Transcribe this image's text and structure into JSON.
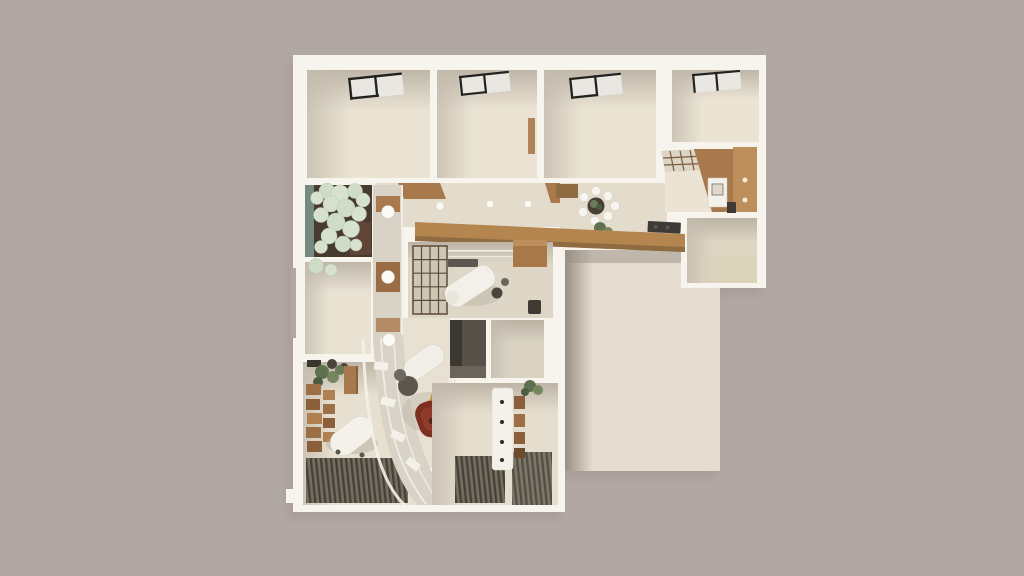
{
  "meta": {
    "canvas": {
      "width": 1024,
      "height": 576
    },
    "visible_text": [],
    "description": "Top-down 3D architectural render of a single floor plan on a plain warm-gray backdrop; no text, labels or UI controls are visible in the image."
  },
  "palette": {
    "bg": "#b2a8a3",
    "wall": "#f7f4ee",
    "wallShade": "#d9d3c7",
    "floor": "#ebe4d4",
    "floorDark": "#ded7c8",
    "floorCorridor": "#e3dccc",
    "terrace": "#e5ded0",
    "shadow": "#9c9189",
    "wood": "#a9794e",
    "woodLight": "#bd8f5c",
    "woodDark": "#8f6b42",
    "windowFrame": "#23221f",
    "windowGlass": "#e9e7e2",
    "courtyardDark": "#473b31",
    "courtyardGlass": "#7e9a90",
    "plantPale": "#d6e1ce",
    "plantGreen": "#6a7b55",
    "plantDark": "#4c5c40",
    "plantMid": "#76875f",
    "deckDark": "#45413a",
    "deckLight": "#756e5e",
    "accentRed": "#7d2f22",
    "ochre": "#c29043",
    "grayDark": "#57514a",
    "grayDeep": "#3b3731",
    "whiteFurniture": "#f4f1ea",
    "softShadow": "#b3aa9c"
  },
  "scene": {
    "type": "architectural-floor-plan-3d-render",
    "view": "top-down",
    "regions": [
      "top-room-1",
      "top-room-2",
      "top-room-3",
      "top-room-4",
      "kitchen",
      "dining-area",
      "hallway",
      "courtyard-patio",
      "mid-left-room",
      "treatment-room",
      "dark-storage-room",
      "small-beige-room",
      "entry-room",
      "lower-left-room",
      "curved-lounge",
      "terrace-slab",
      "lower-right-room"
    ],
    "courtyard_circles": [
      [
        327,
        191,
        8
      ],
      [
        317,
        198,
        6.5
      ],
      [
        340,
        194,
        9
      ],
      [
        355,
        191,
        7.5
      ],
      [
        363,
        200,
        7
      ],
      [
        331,
        204,
        8
      ],
      [
        346,
        208,
        9
      ],
      [
        321,
        215,
        7.5
      ],
      [
        359,
        214,
        7.5
      ],
      [
        336,
        222,
        9
      ],
      [
        351,
        229,
        8.5
      ],
      [
        329,
        236,
        8
      ],
      [
        343,
        244,
        8
      ],
      [
        321,
        247,
        6.5
      ],
      [
        356,
        245,
        6
      ],
      [
        316,
        266,
        7.5
      ],
      [
        331,
        270,
        6
      ]
    ],
    "dining_chairs": [
      [
        584,
        197
      ],
      [
        596,
        191
      ],
      [
        608,
        196
      ],
      [
        615,
        206
      ],
      [
        608,
        216
      ],
      [
        595,
        221
      ],
      [
        583,
        212
      ]
    ],
    "shelf_boxes": [
      [
        306,
        384,
        15,
        11
      ],
      [
        306,
        399,
        14,
        11
      ],
      [
        307,
        413,
        15,
        11
      ],
      [
        306,
        427,
        15,
        11
      ],
      [
        307,
        441,
        15,
        11
      ],
      [
        323,
        390,
        12,
        10
      ],
      [
        323,
        404,
        12,
        10
      ],
      [
        323,
        418,
        12,
        10
      ],
      [
        323,
        432,
        12,
        10
      ]
    ],
    "hall_lights": [
      [
        393,
        208,
        5
      ],
      [
        440,
        206,
        4
      ],
      [
        490,
        204,
        3.5
      ],
      [
        528,
        204,
        3.5
      ]
    ],
    "band_lights": [
      [
        388,
        212,
        6.5
      ],
      [
        388,
        277,
        6.5
      ],
      [
        389,
        340,
        6.5
      ]
    ]
  }
}
